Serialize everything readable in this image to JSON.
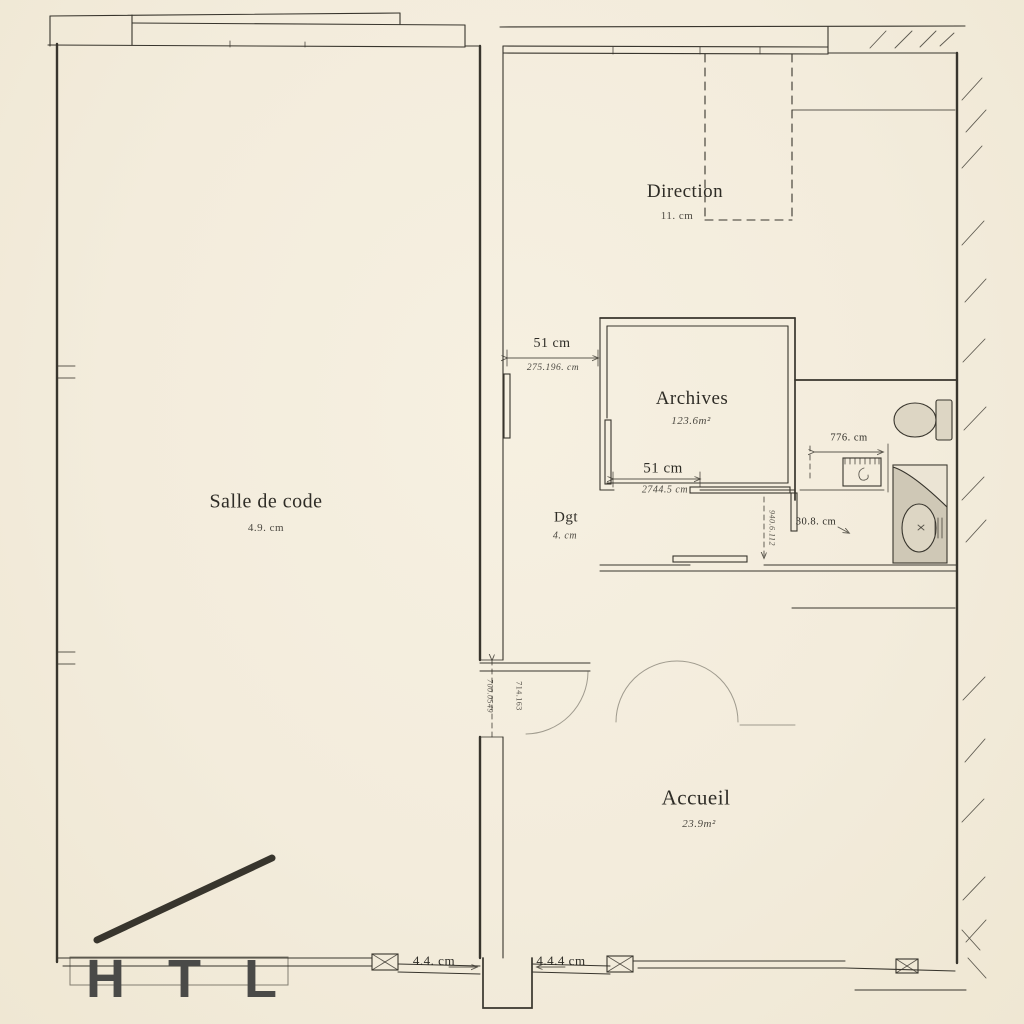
{
  "rooms": {
    "salle": {
      "name": "Salle de code",
      "area": "4.9. cm"
    },
    "direction": {
      "name": "Direction",
      "area": "11. cm"
    },
    "archives": {
      "name": "Archives",
      "area": "123.6m²"
    },
    "dgt": {
      "name": "Dgt",
      "area": "4. cm"
    },
    "accueil": {
      "name": "Accueil",
      "area": "23.9m²"
    }
  },
  "dimensions": {
    "corridor": {
      "value": "51 cm",
      "detail": "275.196. cm"
    },
    "archives_opening": {
      "value": "51 cm",
      "detail": "2744.5 cm"
    },
    "wc_width": {
      "value": "776. cm"
    },
    "sink_offset": {
      "value": "30.8. cm"
    },
    "entrance_left": {
      "value": "4.4. cm"
    },
    "entrance_right": {
      "value": "4.4.4 cm"
    },
    "hall_door_a": {
      "value": "700.0549"
    },
    "hall_door_b": {
      "value": "714.163"
    },
    "wc_vertical": {
      "value": "940.6.112"
    }
  },
  "logo": {
    "text": "H T L"
  },
  "colors": {
    "paper": "#f3ecdc",
    "ink": "#38352d",
    "accent_green": "#9cc19c",
    "logo_gray": "#4a4a48",
    "counter_gray": "#cfc8b6"
  }
}
